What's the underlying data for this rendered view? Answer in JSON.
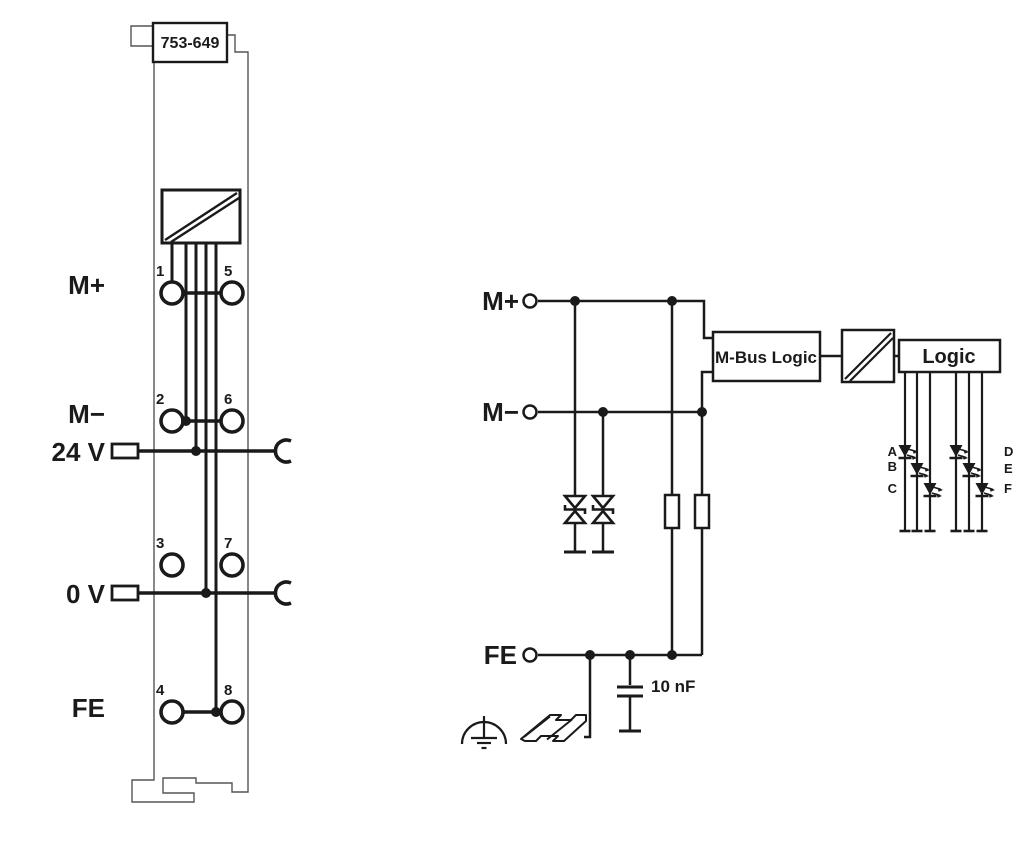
{
  "module": {
    "part_number": "753-649",
    "side_labels": {
      "row1": "M+",
      "row2": "M−",
      "power24": "24 V",
      "power0": "0 V",
      "fe": "FE"
    },
    "terminal_numbers": {
      "t1": "1",
      "t5": "5",
      "t2": "2",
      "t6": "6",
      "t3": "3",
      "t7": "7",
      "t4": "4",
      "t8": "8"
    }
  },
  "schematic": {
    "signal_labels": {
      "m_plus": "M+",
      "m_minus": "M−",
      "fe": "FE"
    },
    "blocks": {
      "mbus_logic": "M-Bus Logic",
      "logic": "Logic"
    },
    "capacitor_value": "10 nF",
    "led_labels": {
      "a": "A",
      "b": "B",
      "c": "C",
      "d": "D",
      "e": "E",
      "f": "F"
    }
  },
  "colors": {
    "ink": "#1a1a1a",
    "background": "#ffffff"
  }
}
